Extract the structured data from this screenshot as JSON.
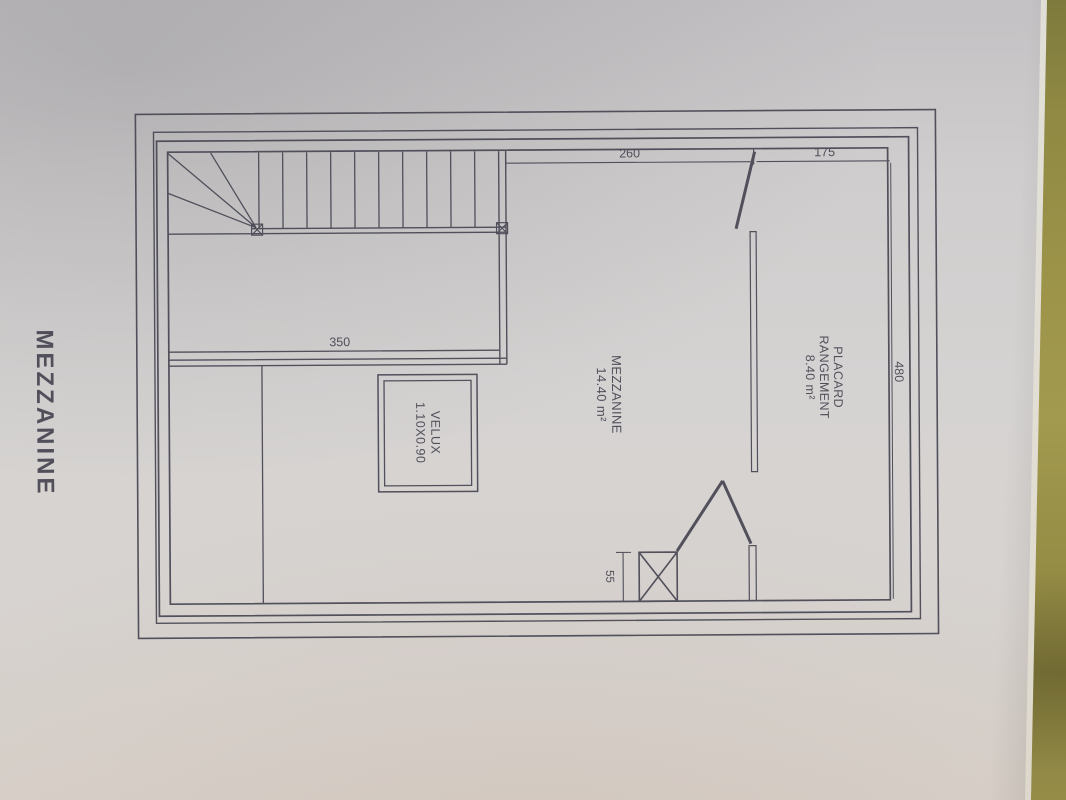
{
  "page_title": "MEZZANINE",
  "plan": {
    "rooms": {
      "mezzanine": {
        "name": "MEZZANINE",
        "area": "14.40 m²"
      },
      "placard": {
        "name_line1": "PLACARD",
        "name_line2": "RANGEMENT",
        "area": "8.40 m²"
      },
      "velux": {
        "name": "VELUX",
        "size": "1.10X0.90"
      }
    },
    "dimensions": {
      "stair_to_partition": "260",
      "partition_to_wall": "175",
      "stairwell_width": "350",
      "room_depth": "480",
      "duct_width": "55"
    }
  },
  "colors": {
    "ink": "#4c4b57",
    "paper": "#d2d0cf",
    "backdrop_green": "#99914a"
  }
}
